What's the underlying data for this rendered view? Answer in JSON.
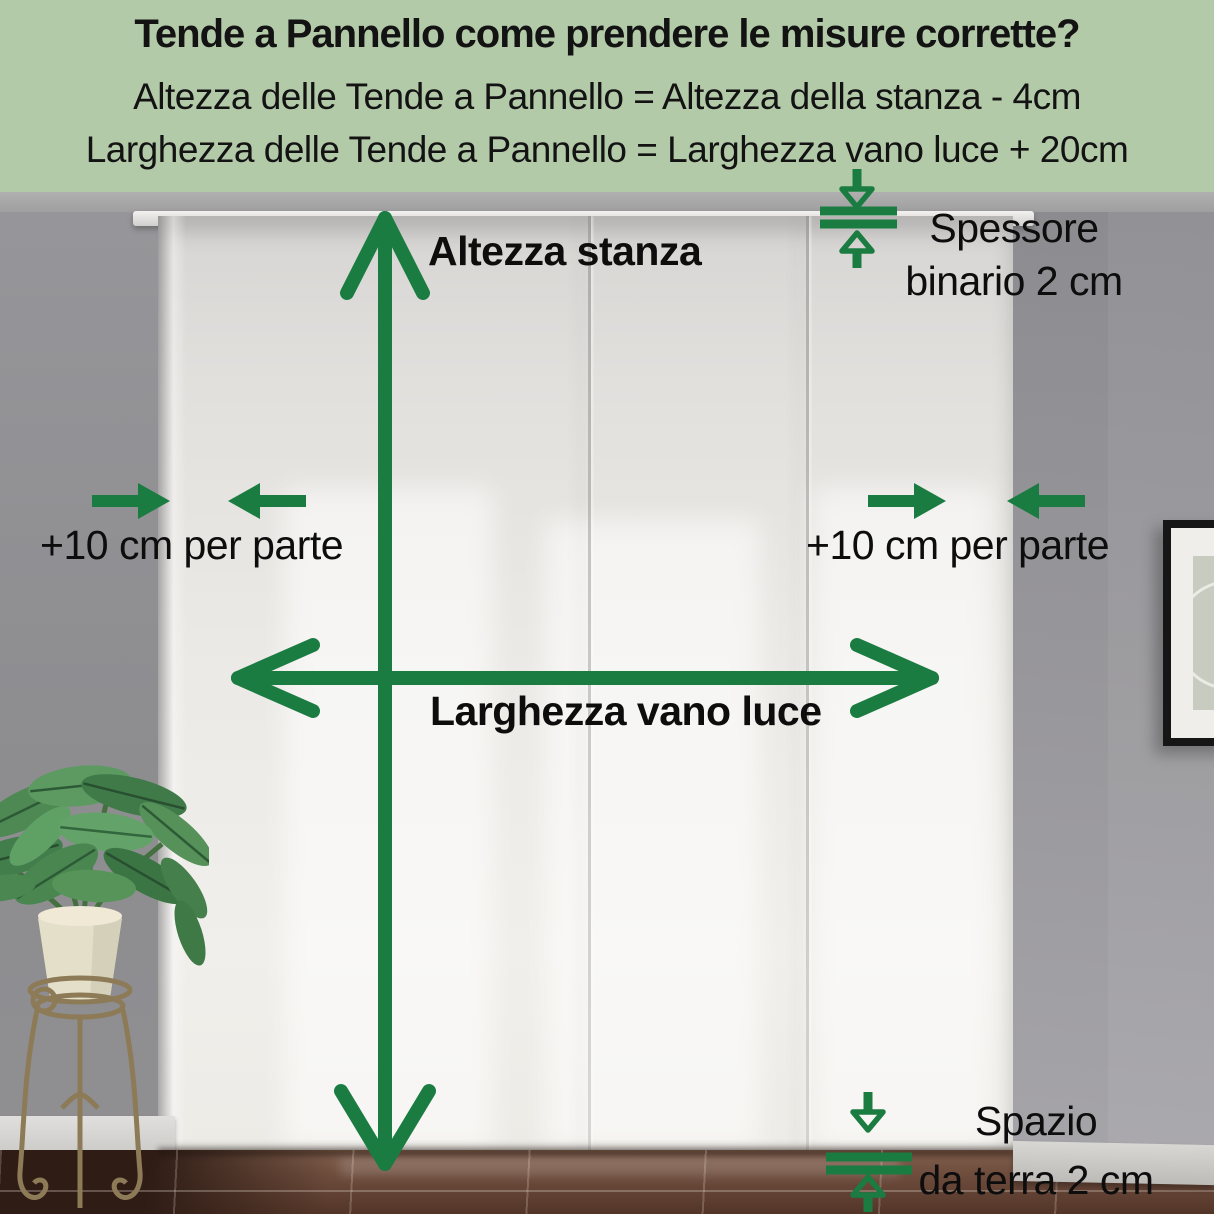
{
  "colors": {
    "header_bg": "#b3caa9",
    "accent_green": "#1b7c42",
    "label_text": "#0d0d0d"
  },
  "header": {
    "title": "Tende a Pannello come prendere le misure corrette?",
    "formula_height": "Altezza delle Tende a Pannello = Altezza della stanza - 4cm",
    "formula_width": "Larghezza delle Tende a Pannello = Larghezza vano luce + 20cm"
  },
  "labels": {
    "room_height": "Altezza stanza",
    "window_width": "Larghezza vano luce",
    "left_extension": "+10 cm per parte",
    "right_extension": "+10 cm per parte",
    "track_thickness_line1": "Spessore",
    "track_thickness_line2": "binario 2 cm",
    "floor_gap_line1": "Spazio",
    "floor_gap_line2": "da terra 2 cm"
  },
  "icons": {
    "room_height_arrow": "double-arrow-vertical",
    "window_width_arrow": "double-arrow-horizontal",
    "left_extension_arrows": "arrows-pointing-inward",
    "right_extension_arrows": "arrows-pointing-inward",
    "track_thickness_gap": "gap-measure-arrows",
    "floor_gap": "gap-measure-arrows"
  }
}
